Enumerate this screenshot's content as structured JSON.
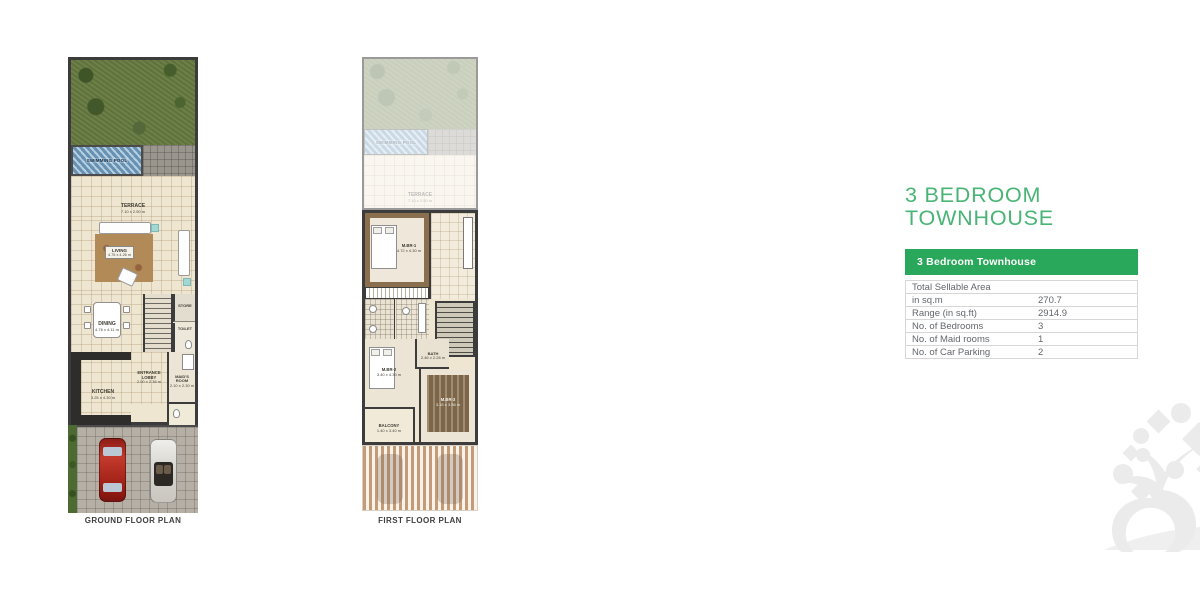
{
  "title": {
    "line1": "3 BEDROOM",
    "line2": "TOWNHOUSE"
  },
  "colors": {
    "title_green": "#49b475",
    "table_header_green": "#29a75a",
    "wall_dark": "#3c3c3c",
    "floor_beige": "#efe6d2",
    "pool_blue": "#7ba7c7",
    "grass_green": "#66793f"
  },
  "spec_table": {
    "header": "3 Bedroom Townhouse",
    "rows": [
      {
        "label": "Total Sellable Area",
        "value": ""
      },
      {
        "label": "in sq.m",
        "value": "270.7"
      },
      {
        "label": "Range (in sq.ft)",
        "value": "2914.9"
      },
      {
        "label": "No. of Bedrooms",
        "value": "3"
      },
      {
        "label": "No. of Maid rooms",
        "value": "1"
      },
      {
        "label": "No. of Car Parking",
        "value": "2"
      }
    ]
  },
  "plans": {
    "ground": {
      "caption": "GROUND FLOOR PLAN",
      "labels": {
        "pool": "SWIMMING POOL",
        "terrace": "TERRACE",
        "terrace_dim": "7.10 x 2.50 m",
        "living": "LIVING",
        "living_dim": "4.75 x 4.26 m",
        "dining": "DINING",
        "dining_dim": "4.76 x 4.11 m",
        "kitchen": "KITCHEN",
        "kitchen_dim": "3.25 x 4.30 m",
        "lobby": "ENTRANCE LOBBY",
        "lobby_dim": "2.00 x 2.36 m",
        "maid": "MAID'S ROOM",
        "maid_dim": "2.10 x 2.30 m",
        "store": "STORE",
        "toilet": "TOILET",
        "up": "UP"
      }
    },
    "first": {
      "caption": "FIRST FLOOR PLAN",
      "labels": {
        "pool": "SWIMMING POOL",
        "terrace": "TERRACE",
        "terrace_dim": "7.10 x 2.50 m",
        "mbr1": "M.BR-1",
        "mbr1_dim": "4.72 x 4.30 m",
        "mbr2": "M.BR-2",
        "mbr2_dim": "3.40 x 4.30 m",
        "mbr3": "M.BR-3",
        "mbr3_dim": "3.15 x 3.56 m",
        "bath": "BATH",
        "bath_dim": "2.46 x 2.26 m",
        "balcony": "BALCONY",
        "balcony_dim": "1.40 x 3.40 m",
        "dn": "DN"
      }
    }
  }
}
